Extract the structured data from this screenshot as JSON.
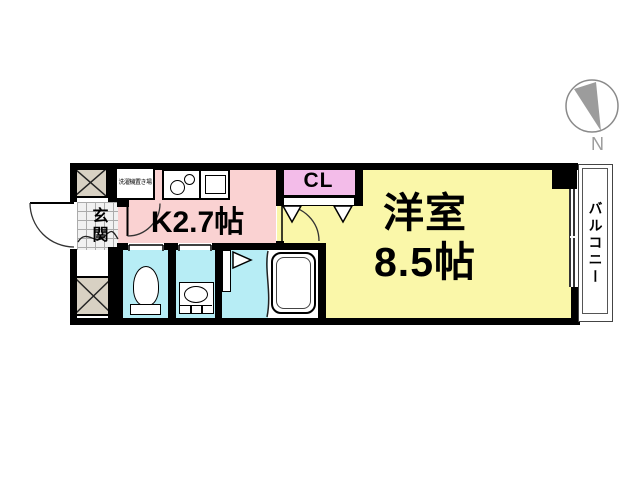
{
  "compass": {
    "north_label": "N"
  },
  "rooms": {
    "western": {
      "line1": "洋室",
      "line2": "8.5帖"
    },
    "kitchen": {
      "label": "K2.7帖"
    },
    "closet": {
      "label": "CL"
    },
    "entrance": {
      "label": "玄関"
    },
    "balcony": {
      "label": "バルコニー"
    },
    "laundry": {
      "label": "洗濯機置き場"
    }
  },
  "icons": {
    "compass": "compass-north-icon",
    "stove": "stove-burners-icon",
    "kitchen_sink": "kitchen-sink-icon",
    "toilet": "toilet-icon",
    "washbasin": "washbasin-icon",
    "bathtub": "bathtub-icon",
    "pipe_shaft": "crossed-box-icon"
  },
  "colors": {
    "western_room_yellow": "#FAF7A9",
    "kitchen_pink": "#FAD2D2",
    "closet_pink": "#F3BCE9",
    "wet_area_cyan": "#B7EDF5",
    "shaft_beige": "#D8D1C3",
    "wall_black": "#000000",
    "compass_gray": "#9C9C9C"
  }
}
